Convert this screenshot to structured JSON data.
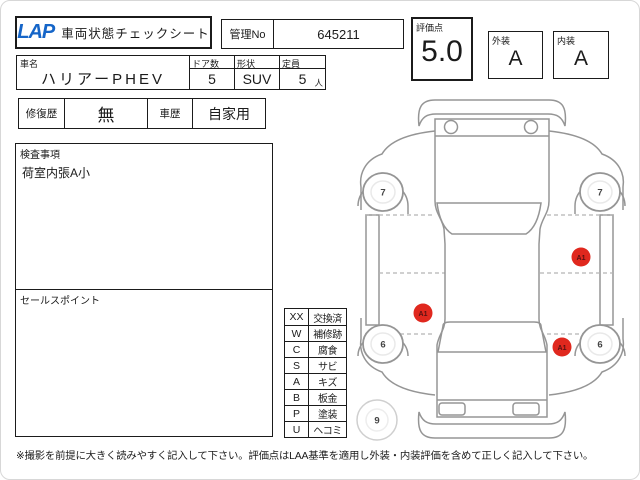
{
  "header": {
    "logo": "LAP",
    "title": "車両状態チェックシート",
    "manage_no_label": "管理No",
    "manage_no_value": "645211"
  },
  "scores": {
    "rating_label": "評価点",
    "rating_value": "5.0",
    "exterior_label": "外装",
    "exterior_value": "A",
    "interior_label": "内装",
    "interior_value": "A"
  },
  "vehicle": {
    "name_label": "車名",
    "name_value": "ハリアーPHEV",
    "doors_label": "ドア数",
    "doors_value": "5",
    "shape_label": "形状",
    "shape_value": "SUV",
    "capacity_label": "定員",
    "capacity_value": "5",
    "capacity_unit": "人"
  },
  "history": {
    "repair_label": "修復歴",
    "repair_value": "無",
    "use_label": "車歴",
    "use_value": "自家用"
  },
  "inspection": {
    "label": "検査事項",
    "content": "荷室内張A小"
  },
  "sales_point": {
    "label": "セールスポイント",
    "content": ""
  },
  "legend": {
    "rows": [
      {
        "code": "XX",
        "desc": "交換済"
      },
      {
        "code": "W",
        "desc": "補修跡"
      },
      {
        "code": "C",
        "desc": "腐食"
      },
      {
        "code": "S",
        "desc": "サビ"
      },
      {
        "code": "A",
        "desc": "キズ"
      },
      {
        "code": "B",
        "desc": "板金"
      },
      {
        "code": "P",
        "desc": "塗装"
      },
      {
        "code": "U",
        "desc": "ヘコミ"
      }
    ]
  },
  "diagram": {
    "marker_color": "#e0281e",
    "wheel_marks": [
      {
        "position": "rear-left",
        "value": "7"
      },
      {
        "position": "rear-right",
        "value": "7"
      },
      {
        "position": "front-left",
        "value": "6"
      },
      {
        "position": "front-right",
        "value": "6"
      }
    ],
    "spare_mark": "9",
    "damage_marks": [
      {
        "label": "A1",
        "location": "right-side"
      },
      {
        "label": "A1",
        "location": "left-side"
      },
      {
        "label": "A1",
        "location": "front-right"
      }
    ]
  },
  "footer": {
    "note": "※撮影を前提に大きく読みやすく記入して下さい。評価点はLAA基準を適用し外装・内装評価を含めて正しく記入して下さい。"
  }
}
